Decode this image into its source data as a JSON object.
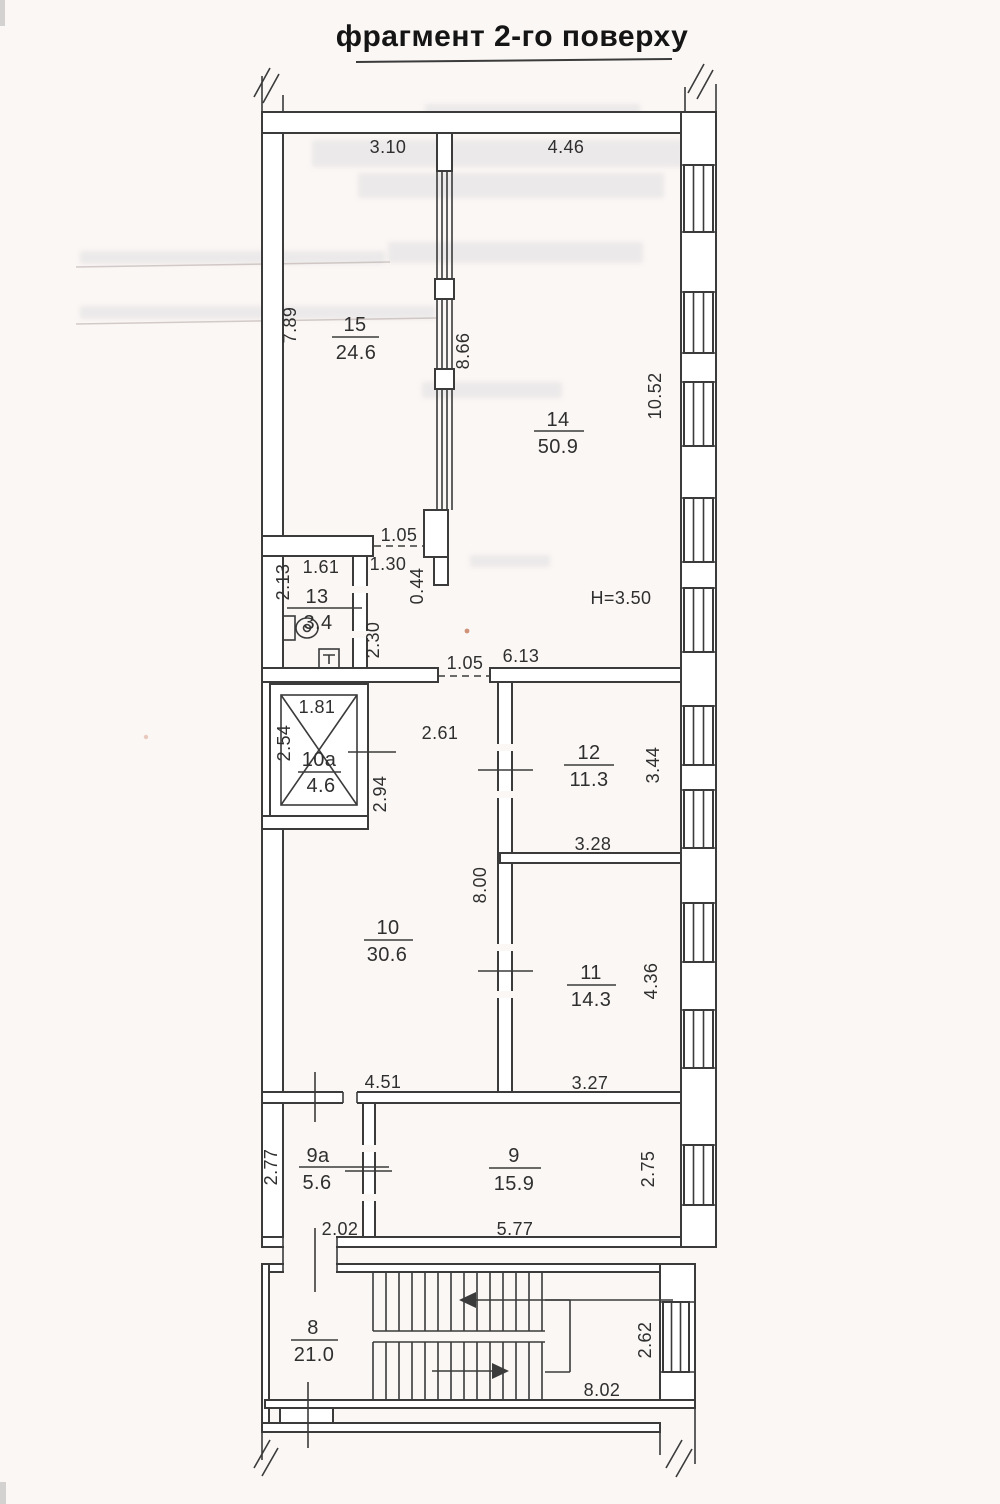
{
  "title": "фрагмент 2-го поверху",
  "plan": {
    "height_note": "H=3.50",
    "rooms": {
      "r15": {
        "number": "15",
        "area": "24.6"
      },
      "r14": {
        "number": "14",
        "area": "50.9"
      },
      "r13": {
        "number": "13",
        "area": "3.4"
      },
      "r10a": {
        "number": "10а",
        "area": "4.6"
      },
      "r12": {
        "number": "12",
        "area": "11.3"
      },
      "r10": {
        "number": "10",
        "area": "30.6"
      },
      "r11": {
        "number": "11",
        "area": "14.3"
      },
      "r9a": {
        "number": "9а",
        "area": "5.6"
      },
      "r9": {
        "number": "9",
        "area": "15.9"
      },
      "r8": {
        "number": "8",
        "area": "21.0"
      }
    },
    "dims": {
      "room15_top": "3.10",
      "room14_top": "4.46",
      "room15_left": "7.89",
      "partition_15_14": "8.66",
      "right_wall_upper": "10.52",
      "opening_top": "1.05",
      "room13_top": "1.61",
      "room13_left": "2.13",
      "jog_width": "1.30",
      "jog_depth": "0.44",
      "room13_right": "2.30",
      "corridor_opening": "1.05",
      "corridor_width": "6.13",
      "shaft_top": "1.81",
      "shaft_left": "2.54",
      "shaft_right": "2.94",
      "hall_gap": "2.61",
      "room12_right": "3.44",
      "room12_bottom": "3.28",
      "wall_10_11": "8.00",
      "room11_right": "4.36",
      "room11_bottom": "3.27",
      "room10_bottom": "4.51",
      "room9a_left": "2.77",
      "room9a_bottom": "2.02",
      "room9_bottom": "5.77",
      "room9_right": "2.75",
      "stair_right": "2.62",
      "stair_bottom": "8.02"
    }
  }
}
